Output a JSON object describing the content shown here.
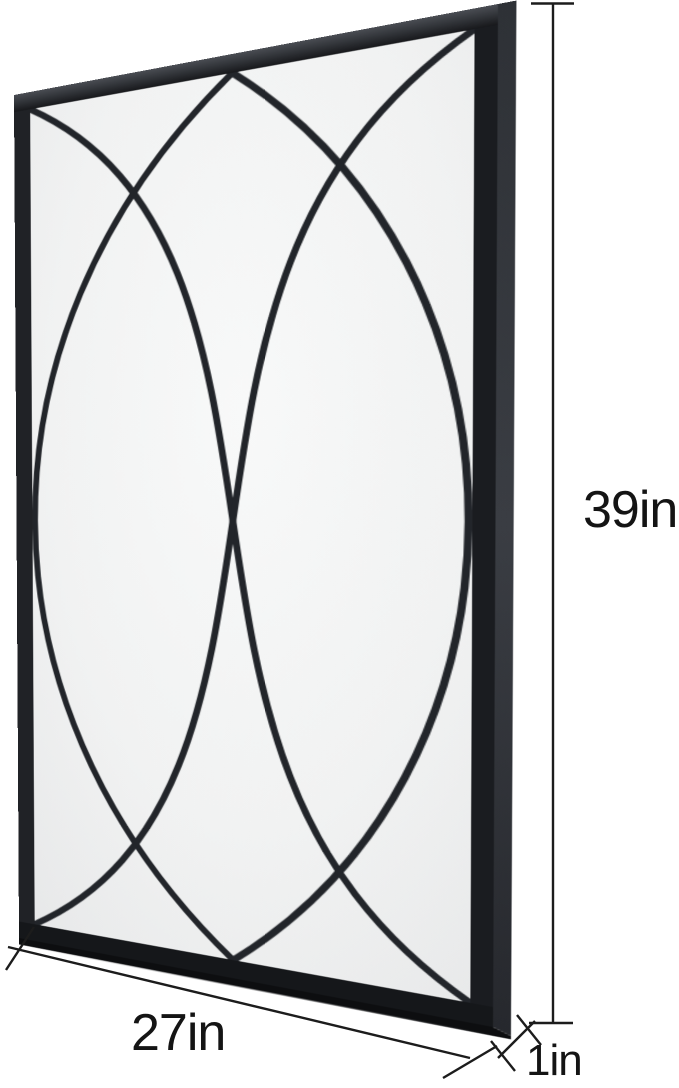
{
  "scene": {
    "type": "product dimension diagram",
    "subject": "rectangular black metal wall mirror with overlapping-arc window-pane overlay, shown in slight perspective",
    "background_color": "#ffffff"
  },
  "mirror": {
    "frame_color": "#1d1f23",
    "frame_top_rail_color": "#4a4d53",
    "frame_side_face_color": "#3a3d43",
    "frame_underside_color": "#0d0e10",
    "glass_center_color": "#f8f9f9",
    "glass_edge_color": "#e6e7e8",
    "overlay_bar_color": "#22252a"
  },
  "annotations": {
    "line_color": "#1c1c1c",
    "text_color": "#141414",
    "height": {
      "label": "39in"
    },
    "width": {
      "label": "27in"
    },
    "depth": {
      "label": "1in"
    }
  }
}
